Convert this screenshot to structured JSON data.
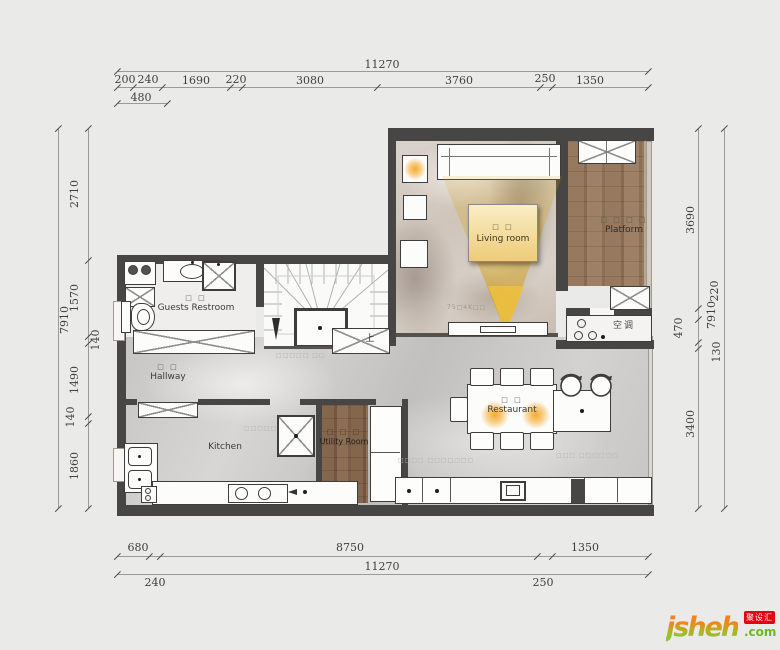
{
  "watermark": {
    "brand": "jsheh",
    "tld": ".com",
    "badge": "聚设汇"
  },
  "dims": {
    "top": {
      "total": "11270",
      "segments": [
        "200",
        "240",
        "1690",
        "220",
        "3080",
        "3760",
        "250",
        "1350"
      ],
      "sub": "480"
    },
    "bottom": {
      "total": "11270",
      "segments": [
        "680",
        "8750",
        "1350"
      ],
      "sub": [
        "240",
        "250"
      ]
    },
    "left": {
      "total": "7910",
      "segments": [
        "2710",
        "1570",
        "140",
        "1490",
        "140",
        "1860"
      ]
    },
    "right": {
      "total": "7910",
      "segments": [
        "3690",
        "220",
        "470",
        "130",
        "3400"
      ]
    }
  },
  "rooms": {
    "living": {
      "cjk": "□ □",
      "name": "Living room"
    },
    "platform": {
      "cjk": "□ □ □ □",
      "name": "Platform"
    },
    "restroom": {
      "cjk": "□ □",
      "name": "Guests Restroom"
    },
    "hallway": {
      "cjk": "□ □",
      "name": "Hallway"
    },
    "kitchen": {
      "name": "Kitchen"
    },
    "utility": {
      "cjk": "□ □ □",
      "name": "Utility Room"
    },
    "restaurant": {
      "cjk": "□ □",
      "name": "Restaurant"
    }
  },
  "annotations": {
    "ac": "空调",
    "tv": "75□4K□□",
    "up": "上",
    "notes": [
      "□□□□□ □□",
      "□□□□□",
      "□□□□ □□□□□□□",
      "□□□ □□□□□□"
    ]
  },
  "colors": {
    "wall": "#474645",
    "label_yellow": "#EFCF7E",
    "wood": "#8D7055",
    "marble": "#C9C8C6",
    "badge_red": "#E60012",
    "brand_orange": "#F08519",
    "brand_green": "#7FBE26",
    "glow_orange": "#F3A623"
  }
}
